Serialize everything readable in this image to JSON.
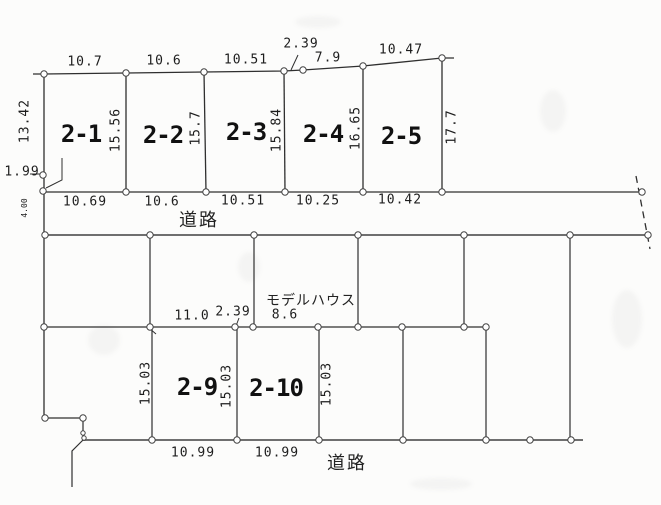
{
  "roads": {
    "top_label": "道路",
    "bottom_label": "道路",
    "width_dim": "4.00"
  },
  "annotations": {
    "model_house": "モデルハウス",
    "left_offset_dim": "1.99"
  },
  "block1": {
    "plot_labels": [
      "2-1",
      "2-2",
      "2-3",
      "2-4",
      "2-5"
    ],
    "top_dims": [
      "10.7",
      "10.6",
      "10.51",
      "2.39",
      "7.9",
      "10.47"
    ],
    "bottom_dims": [
      "10.69",
      "10.6",
      "10.51",
      "10.25",
      "10.42"
    ],
    "side_dims": [
      "13.42",
      "15.56",
      "15.7",
      "15.84",
      "16.65",
      "17.7"
    ]
  },
  "block2": {
    "plot_labels": [
      "2-9",
      "2-10"
    ],
    "top_dims": [
      "11.0",
      "2.39",
      "8.6"
    ],
    "bottom_dims": [
      "10.99",
      "10.99"
    ],
    "side_dims": [
      "15.03",
      "15.03",
      "15.03"
    ]
  },
  "colors": {
    "boundary_line": "#2f2f2f",
    "road_line": "#6f6f6f",
    "text": "#1d1d1d",
    "marker_fill": "#ffffff",
    "marker_stroke": "#444444"
  }
}
